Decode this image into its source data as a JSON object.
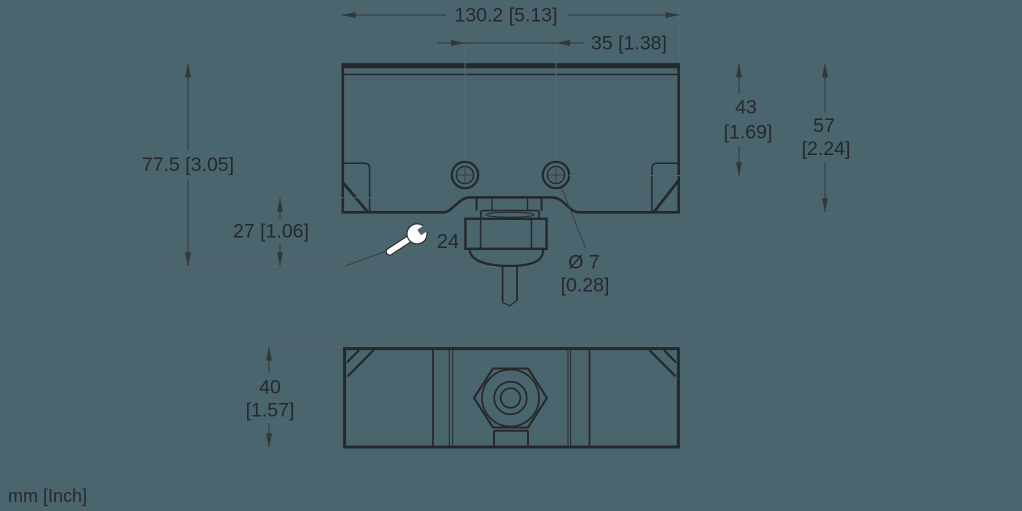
{
  "units_label": "mm [Inch]",
  "colors": {
    "background": "#4a656d",
    "object_line": "#26292b",
    "dimension_line": "#393d3f",
    "extension_line": "#5d676b",
    "text": "#26292b",
    "wrench_fill": "#ffffff"
  },
  "front_view": {
    "dim_width": "130.2 [5.13]",
    "dim_hole_spacing": "35 [1.38]",
    "dim_total_height": "77.5 [3.05]",
    "dim_gland_drop": "27 [1.06]",
    "dim_hole_offset_mm": "43",
    "dim_hole_offset_in": "[1.69]",
    "dim_body_height_mm": "57",
    "dim_body_height_in": "[2.24]",
    "dim_cable_dia_mm": "Ø 7",
    "dim_cable_dia_in": "[0.28]",
    "wrench_size": "24"
  },
  "bottom_view": {
    "dim_depth_mm": "40",
    "dim_depth_in": "[1.57]"
  }
}
